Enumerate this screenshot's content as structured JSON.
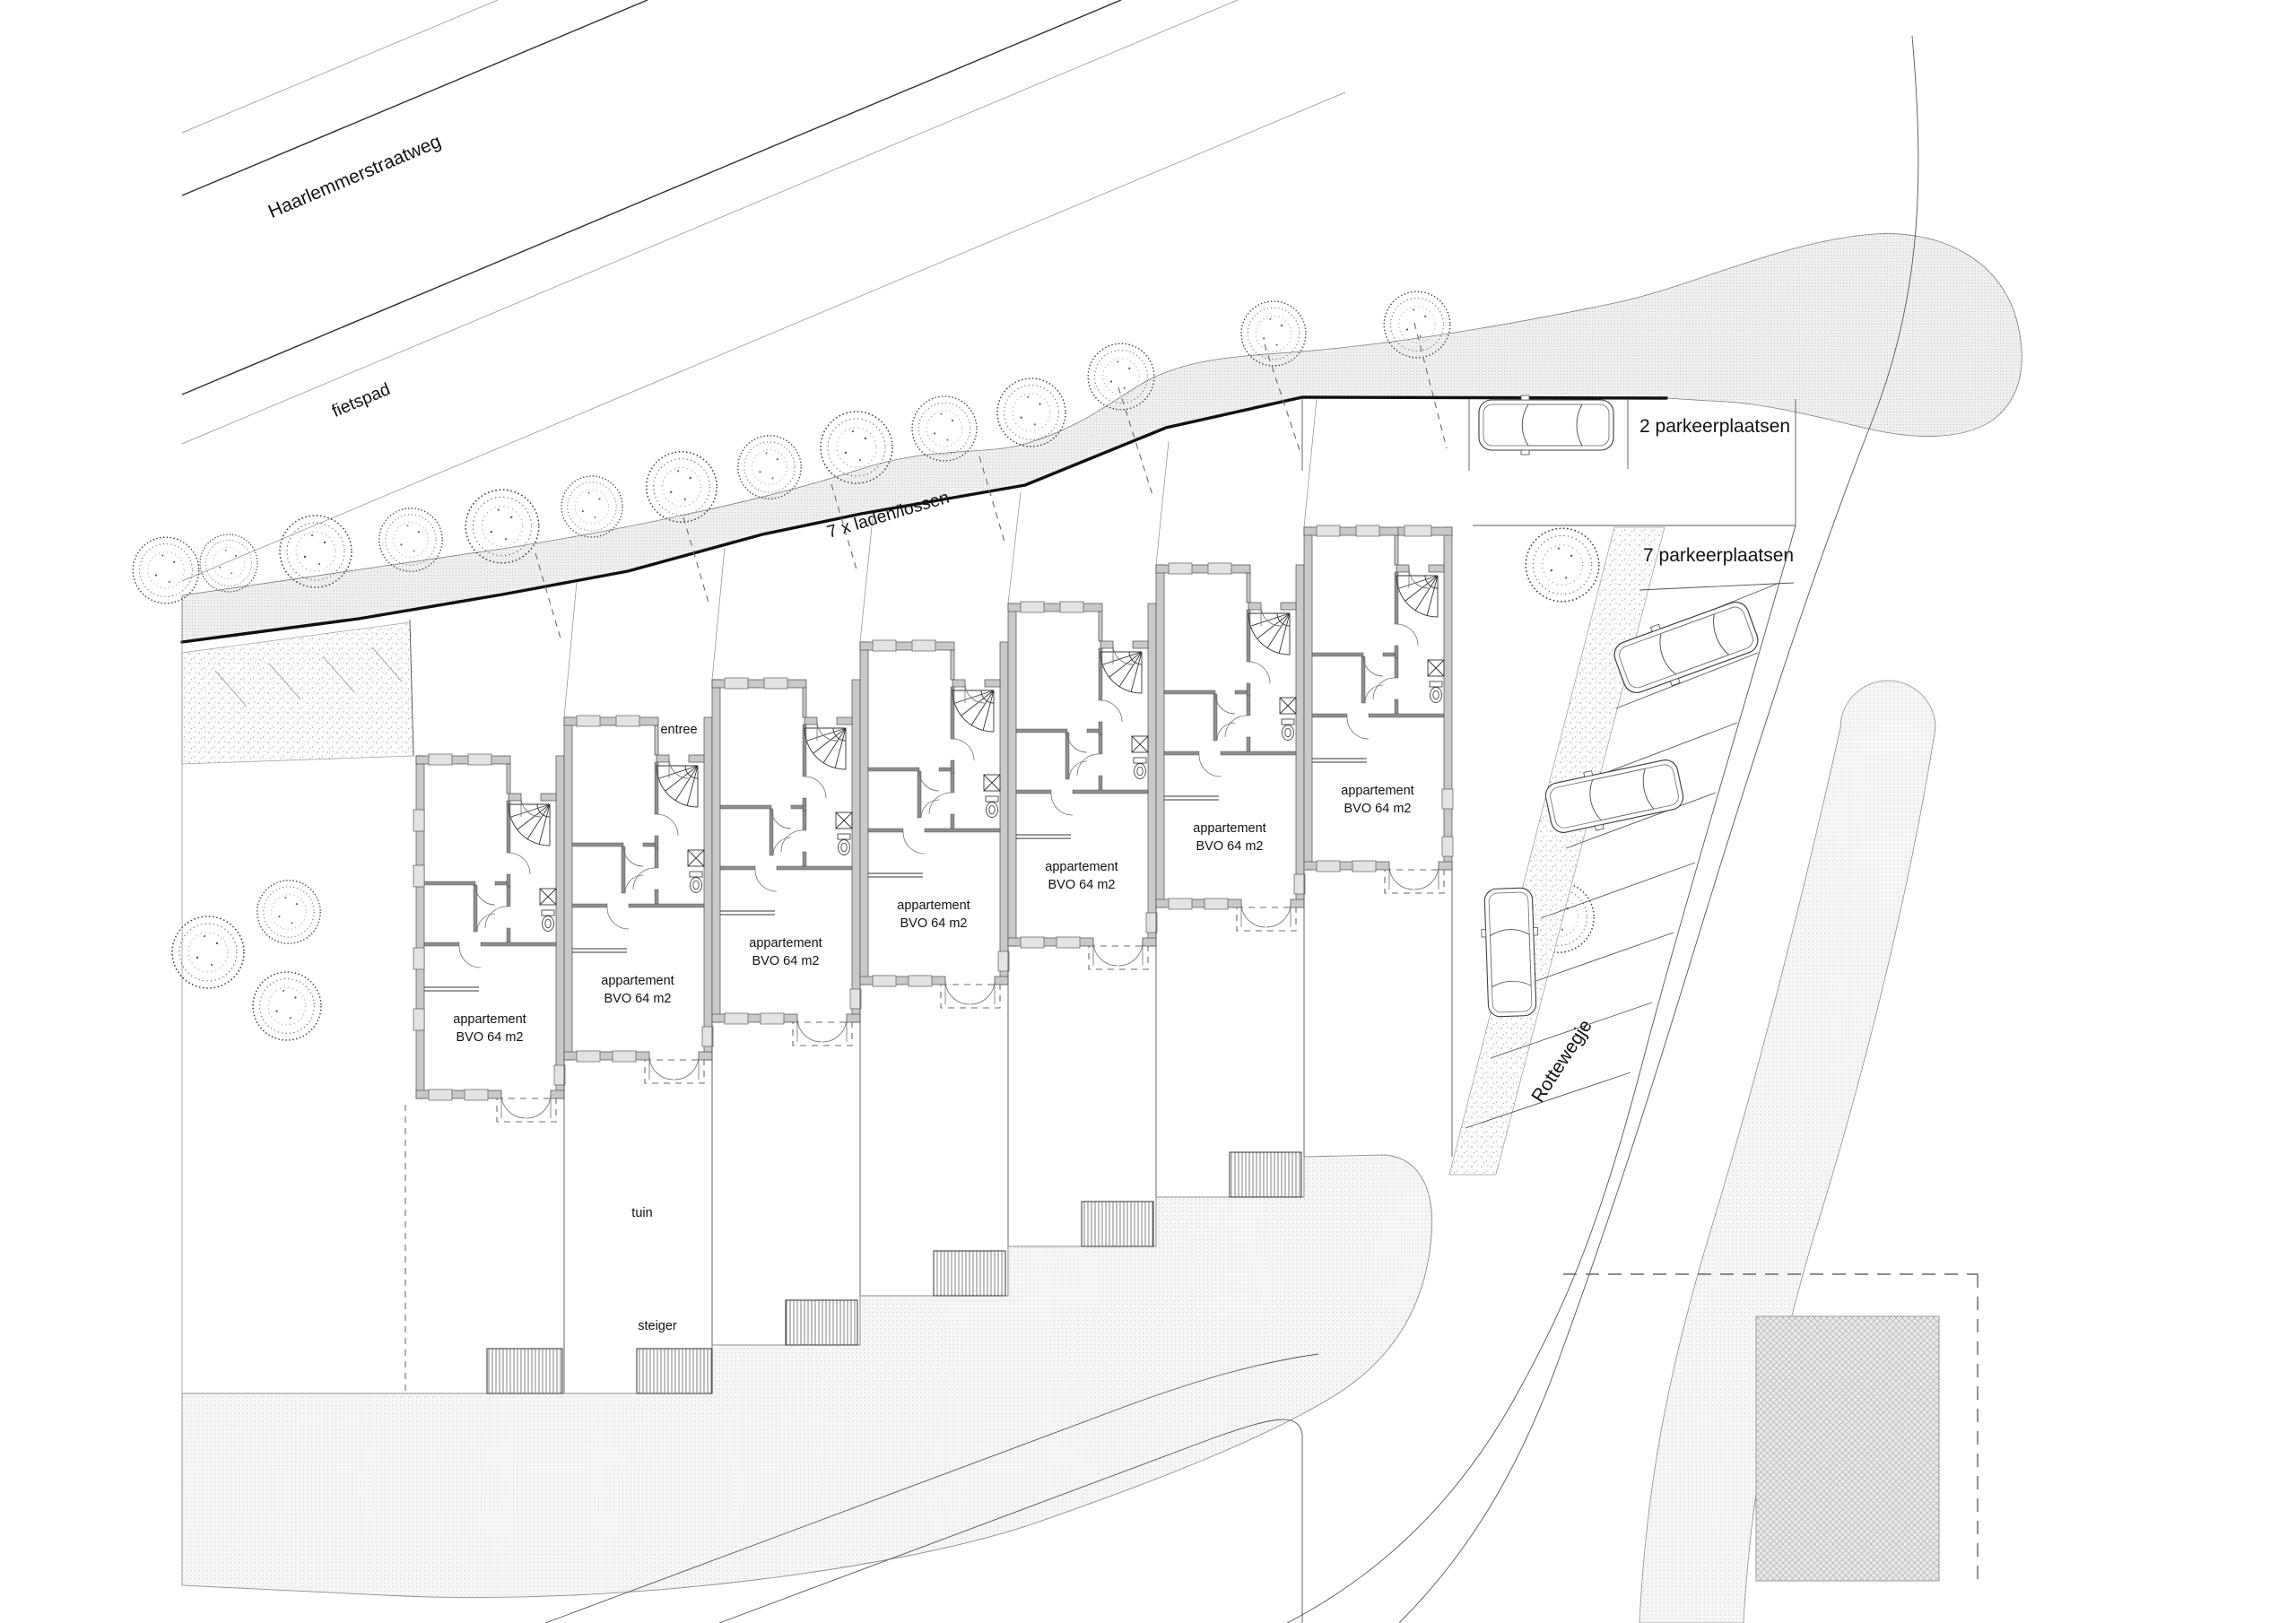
{
  "streets": {
    "haarlemmerstraatweg": "Haarlemmerstraatweg",
    "fietspad": "fietspad",
    "rottewegje": "Rottewegje"
  },
  "annotations": {
    "loading_zone": "7 x laden/lossen",
    "parking_2": "2 parkeerplaatsen",
    "parking_7": "7 parkeerplaatsen",
    "entrance": "entree",
    "garden": "tuin",
    "jetty": "steiger"
  },
  "units": [
    {
      "label": "appartement",
      "area": "BVO 64 m2"
    },
    {
      "label": "appartement",
      "area": "BVO 64 m2"
    },
    {
      "label": "appartement",
      "area": "BVO 64 m2"
    },
    {
      "label": "appartement",
      "area": "BVO 64 m2"
    },
    {
      "label": "appartement",
      "area": "BVO 64 m2"
    },
    {
      "label": "appartement",
      "area": "BVO 64 m2"
    },
    {
      "label": "appartement",
      "area": "BVO 64 m2"
    }
  ],
  "colors": {
    "line": "#1a1a1a",
    "wall_fill": "#c9c9c9",
    "paving": "#ededed",
    "background": "#ffffff"
  }
}
